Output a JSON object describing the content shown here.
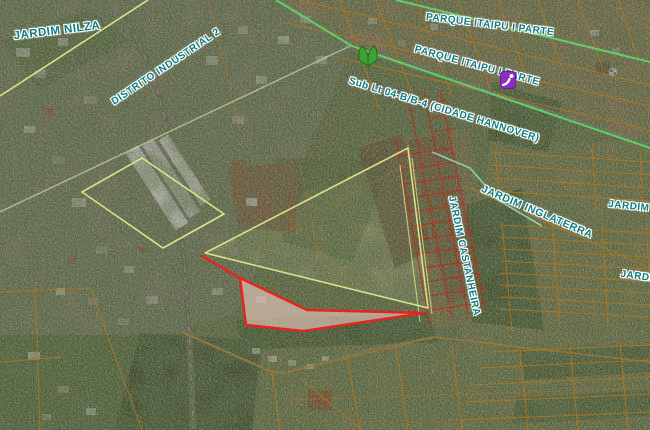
{
  "map": {
    "labels": [
      {
        "id": "jardim-nilza",
        "text": "JARDIM NILZA"
      },
      {
        "id": "distrito-industrial-2",
        "text": "DISTRITO INDUSTRIAL 2"
      },
      {
        "id": "parque-itaipu-i-parte-upper",
        "text": "PARQUE ITAIPU I PARTE"
      },
      {
        "id": "parque-itaipu-i-parte-lower",
        "text": "PARQUE ITAIPU I PARTE"
      },
      {
        "id": "cidade-hannover",
        "text": "Sub Lt 04-B/B-4 (CIDADE HANNOVER)"
      },
      {
        "id": "jardim-inglaterra",
        "text": "JARDIM INGLATERRA"
      },
      {
        "id": "jardim-castanheira",
        "text": "JARDIM CASTANHEIRA"
      },
      {
        "id": "jardim-e-partial",
        "text": "JARDIM E"
      },
      {
        "id": "jardim-partial",
        "text": "JARDIM"
      }
    ],
    "icons": [
      {
        "id": "park-icon",
        "color": "#3da233"
      },
      {
        "id": "playground-icon",
        "color": "#8a2dc0"
      }
    ],
    "colors": {
      "label_text": "#0e7c80",
      "label_halo": "#ffffff",
      "parcel_line_orange": "#b5761f",
      "parcel_line_red": "#b23420",
      "boundary_lime": "#dde98a",
      "boundary_green": "#5ecf6a",
      "boundary_teal": "#86dcc4",
      "highlight_outline": "#e8231d",
      "highlight_fill": "#f2cdc4"
    }
  }
}
